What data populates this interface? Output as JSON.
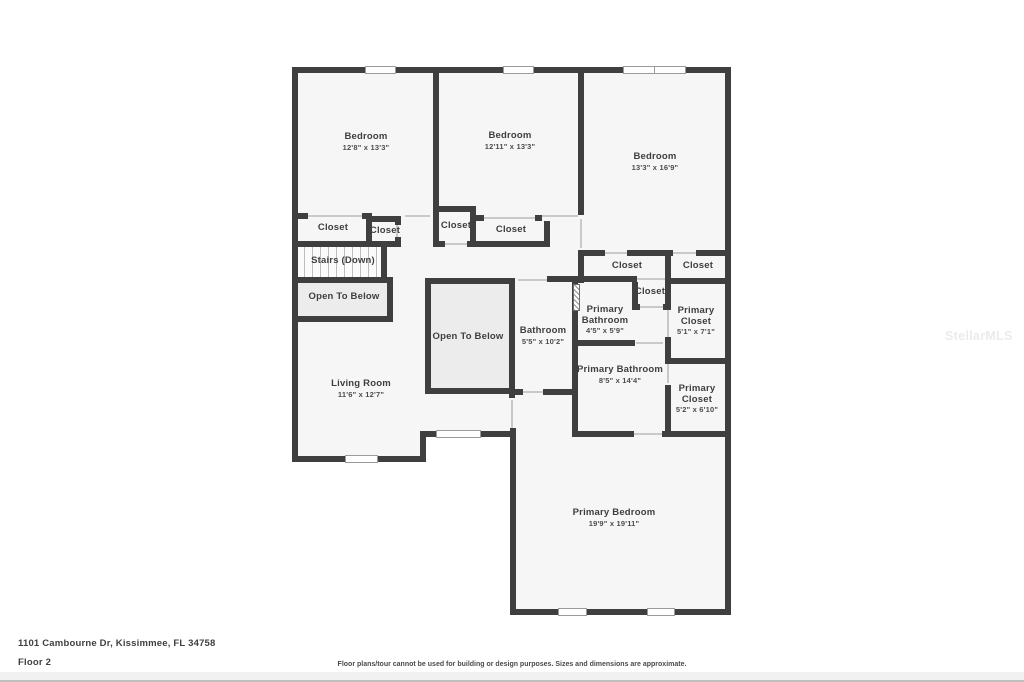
{
  "watermark": "StellarMLS",
  "footer": {
    "address": "1101 Cambourne Dr, Kissimmee, FL 34758",
    "floor": "Floor 2",
    "disclaimer": "Floor plans/tour cannot be used for building or design purposes. Sizes and dimensions are approximate."
  },
  "plan": {
    "wall_color": "#3f3f3f",
    "room_fill": "#f6f6f6",
    "open_area_fill": "#ececec",
    "stairs_tread_count": 10,
    "labels": [
      {
        "id": "bedroom-1",
        "name": "Bedroom",
        "dims": "12'8\" x 13'3\"",
        "x": 366,
        "y": 142
      },
      {
        "id": "bedroom-2",
        "name": "Bedroom",
        "dims": "12'11\" x 13'3\"",
        "x": 510,
        "y": 141
      },
      {
        "id": "bedroom-3",
        "name": "Bedroom",
        "dims": "13'3\" x 16'9\"",
        "x": 655,
        "y": 162
      },
      {
        "id": "closet-bedroom1-a",
        "name": "Closet",
        "x": 333,
        "y": 228
      },
      {
        "id": "closet-bedroom1-b",
        "name": "Closet",
        "x": 385,
        "y": 231
      },
      {
        "id": "stairs-down",
        "name": "Stairs (Down)",
        "x": 343,
        "y": 261
      },
      {
        "id": "open-to-below-left",
        "name": "Open To Below",
        "x": 344,
        "y": 297
      },
      {
        "id": "closet-bedroom2-a",
        "name": "Closet",
        "x": 456,
        "y": 226
      },
      {
        "id": "closet-bedroom2-b",
        "name": "Closet",
        "x": 511,
        "y": 230
      },
      {
        "id": "closet-bedroom3-a",
        "name": "Closet",
        "x": 627,
        "y": 266
      },
      {
        "id": "closet-bedroom3-b",
        "name": "Closet",
        "x": 698,
        "y": 266
      },
      {
        "id": "closet-small",
        "name": "Closet",
        "x": 650,
        "y": 292
      },
      {
        "id": "primary-bathroom-small",
        "name": "Primary Bathroom",
        "dims": "4'5\" x 5'9\"",
        "x": 605,
        "y": 320,
        "maxw": 55
      },
      {
        "id": "primary-closet-1",
        "name": "Primary Closet",
        "dims": "5'1\" x 7'1\"",
        "x": 696,
        "y": 321,
        "maxw": 48
      },
      {
        "id": "bathroom",
        "name": "Bathroom",
        "dims": "5'5\" x 10'2\"",
        "x": 543,
        "y": 336
      },
      {
        "id": "open-to-below-center",
        "name": "Open To Below",
        "x": 468,
        "y": 337
      },
      {
        "id": "primary-bathroom",
        "name": "Primary Bathroom",
        "dims": "8'5\" x 14'4\"",
        "x": 620,
        "y": 375,
        "maxw": 110
      },
      {
        "id": "primary-closet-2",
        "name": "Primary Closet",
        "dims": "5'2\" x 6'10\"",
        "x": 697,
        "y": 399,
        "maxw": 48
      },
      {
        "id": "living-room",
        "name": "Living Room",
        "dims": "11'6\" x 12'7\"",
        "x": 361,
        "y": 389
      },
      {
        "id": "primary-bedroom",
        "name": "Primary Bedroom",
        "dims": "19'9\" x 19'11\"",
        "x": 614,
        "y": 518
      }
    ]
  }
}
